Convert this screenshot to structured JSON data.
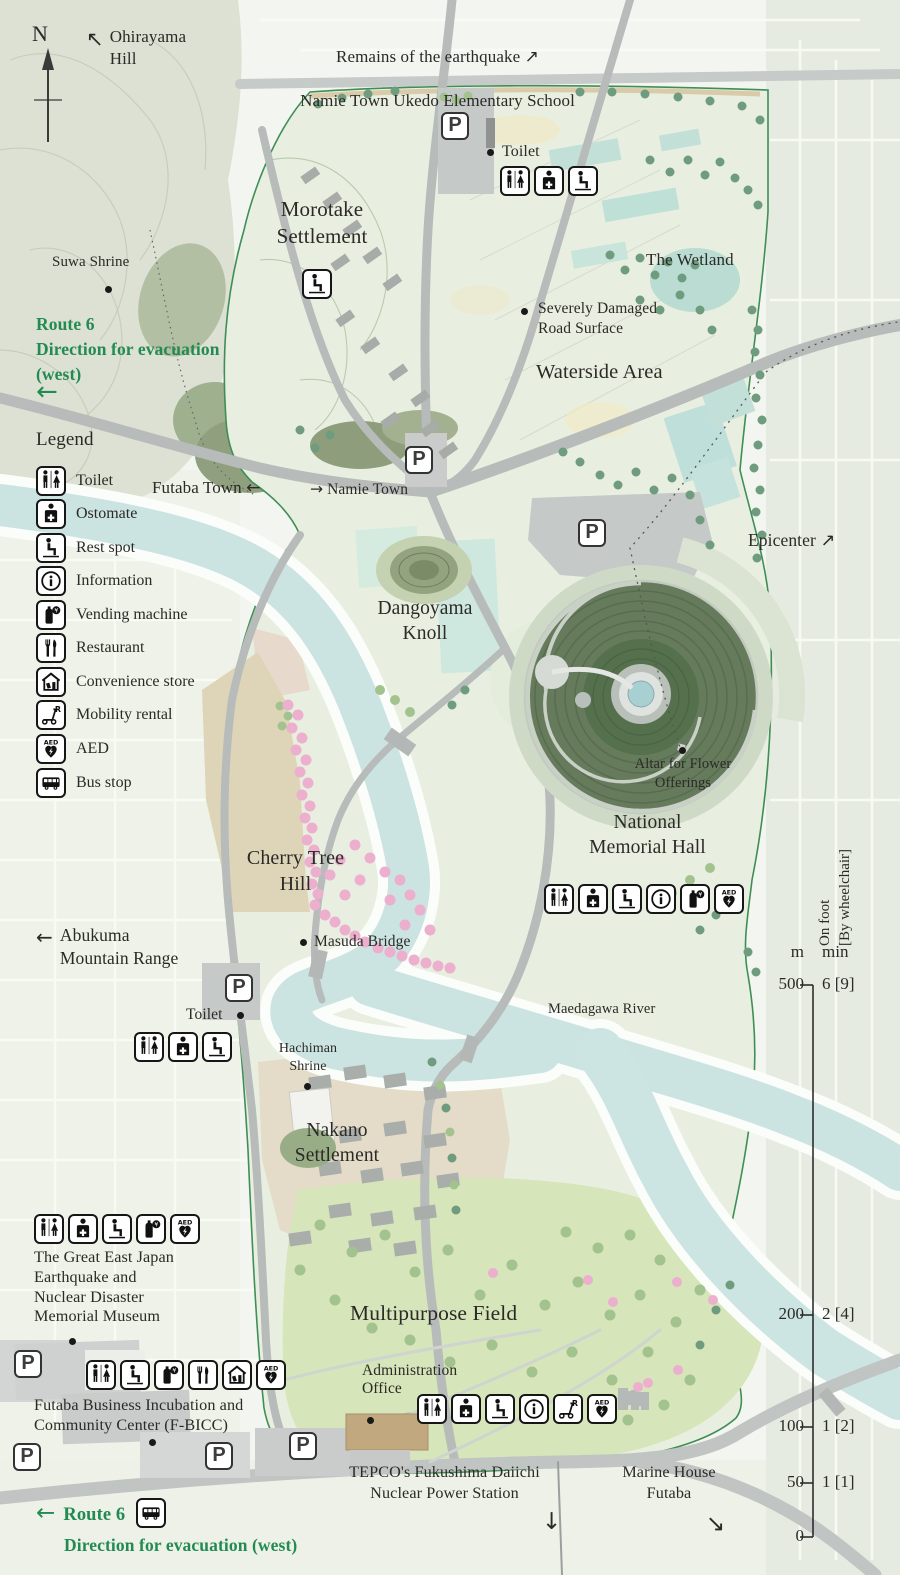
{
  "colors": {
    "accent_green": "#238b52",
    "label_dark": "#2b2a27",
    "park_fill": "#e9efe0",
    "boundary_green": "#3f8e55",
    "water": "#cbe4e1",
    "road_gray": "#b7bbba",
    "mound_dark": "#55704d",
    "cherry_pink": "#ecafce"
  },
  "compass": {
    "north": "N"
  },
  "parking_glyph": "P",
  "labels": {
    "ohirayama_arrow": "↖",
    "ohirayama": "Ohirayama Hill",
    "remains_line1": "Remains of the earthquake",
    "remains_arrow": "↗",
    "remains_line2": "Namie Town Ukedo Elementary School",
    "morotake": "Morotake\nSettlement",
    "suwa": "Suwa Shrine",
    "toilet_north": "Toilet",
    "wetland": "The Wetland",
    "route6_top": "Route 6\nDirection for evacuation\n(west)",
    "route6_top_arrow": "←",
    "severely": "Severely Damaged\nRoad Surface",
    "waterside": "Waterside Area",
    "futaba_town": "Futaba Town",
    "futaba_arrow": "←",
    "namie_arrow": "→",
    "namie_town": "Namie Town",
    "epicenter": "Epicenter",
    "epicenter_arrow": "↗",
    "dangoyama": "Dangoyama\nKnoll",
    "altar": "Altar for Flower\nOfferings",
    "memorial": "National\nMemorial Hall",
    "abukuma_arrow": "←",
    "abukuma": "Abukuma\nMountain Range",
    "cherry": "Cherry Tree\nHill",
    "masuda": "Masuda Bridge",
    "toilet_cherry": "Toilet",
    "hachiman": "Hachiman\nShrine",
    "nakano": "Nakano\nSettlement",
    "maedagawa": "Maedagawa River",
    "museum": "The Great East Japan\nEarthquake and\nNuclear Disaster\nMemorial Museum",
    "fbicc": "Futaba Business Incubation and\nCommunity Center (F-BICC)",
    "multipurpose": "Multipurpose Field",
    "admin": "Administration\nOffice",
    "tepco": "TEPCO's Fukushima Daiichi\nNuclear Power Station",
    "tepco_arrow": "↓",
    "marine": "Marine House\nFutaba",
    "marine_arrow": "↘",
    "route6_bottom_arrow": "←",
    "route6_bottom": "Route 6",
    "route6_bottom2": "Direction for evacuation (west)"
  },
  "legend": {
    "title": "Legend",
    "items": [
      {
        "icon": "toilet",
        "label": "Toilet"
      },
      {
        "icon": "ostomate",
        "label": "Ostomate"
      },
      {
        "icon": "rest-spot",
        "label": "Rest spot"
      },
      {
        "icon": "information",
        "label": "Information"
      },
      {
        "icon": "vending",
        "label": "Vending machine"
      },
      {
        "icon": "restaurant",
        "label": "Restaurant"
      },
      {
        "icon": "convenience",
        "label": "Convenience store"
      },
      {
        "icon": "mobility",
        "label": "Mobility rental"
      },
      {
        "icon": "aed",
        "label": "AED"
      },
      {
        "icon": "bus",
        "label": "Bus stop"
      }
    ]
  },
  "facilities": {
    "north_toilet": [
      "toilet",
      "ostomate",
      "rest-spot"
    ],
    "morotake_rest": [
      "rest-spot"
    ],
    "memorial_hall": [
      "toilet",
      "ostomate",
      "rest-spot",
      "information",
      "vending",
      "aed"
    ],
    "cherry_toilet": [
      "toilet",
      "ostomate",
      "rest-spot"
    ],
    "museum": [
      "toilet",
      "ostomate",
      "rest-spot",
      "vending",
      "aed"
    ],
    "fbicc": [
      "toilet",
      "rest-spot",
      "vending",
      "restaurant",
      "convenience",
      "aed"
    ],
    "admin": [
      "toilet",
      "ostomate",
      "rest-spot",
      "information",
      "mobility",
      "aed"
    ],
    "route6_bus": [
      "bus"
    ]
  },
  "scale": {
    "col_m": "m",
    "col_min": "min",
    "foot_note": "On foot\n[By wheelchair]",
    "ticks": [
      {
        "m": "500",
        "min": "6 [9]"
      },
      {
        "m": "200",
        "min": "2 [4]"
      },
      {
        "m": "100",
        "min": "1 [2]"
      },
      {
        "m": "50",
        "min": "1 [1]"
      },
      {
        "m": "0",
        "min": ""
      }
    ]
  }
}
